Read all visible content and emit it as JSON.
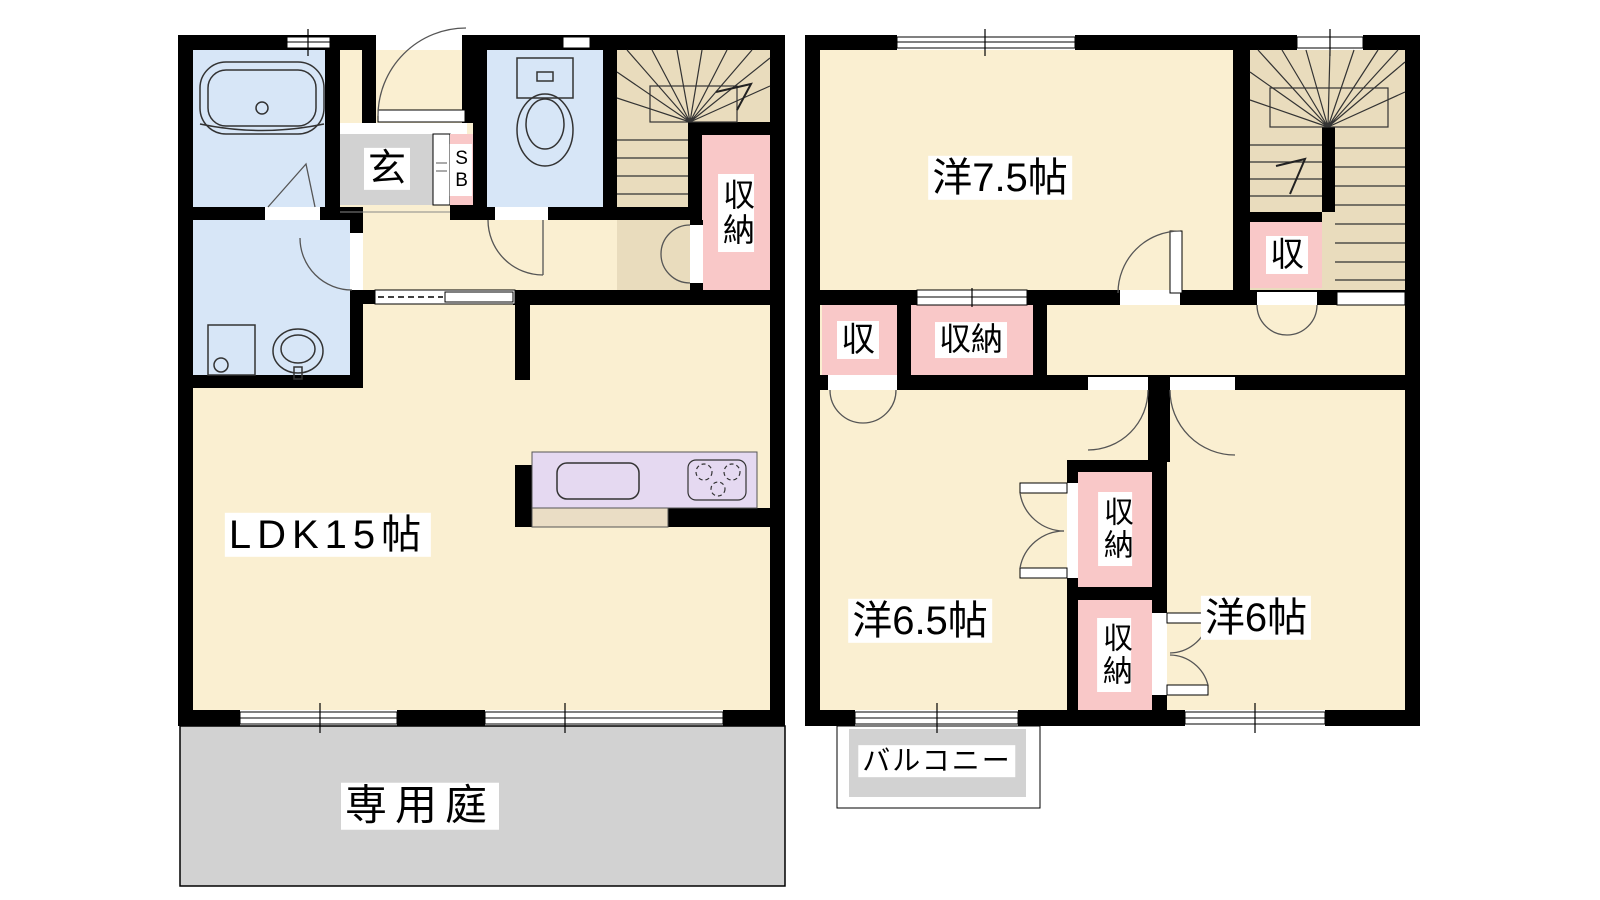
{
  "palette": {
    "wall": "#000000",
    "room": "#faefd1",
    "water": "#d7e6f7",
    "storage": "#f9c8c8",
    "stairs": "#e9dcbd",
    "gray": "#d2d2d2",
    "kitchen": "#e5d9f1",
    "counter": "#eaddc5",
    "label_bg": "#ffffff"
  },
  "floor1": {
    "labels": {
      "entrance": "玄",
      "shoe_box": "SB",
      "closet": "収納",
      "ldk": "LDK15帖",
      "garden": "専用庭"
    }
  },
  "floor2": {
    "labels": {
      "room_7_5": "洋7.5帖",
      "stairs_closet": "収",
      "closet_small": "収",
      "closet_top": "収納",
      "room_6_5": "洋6.5帖",
      "closet_upper": "収納",
      "closet_lower": "収納",
      "room_6": "洋6帖",
      "balcony": "バルコニー"
    }
  }
}
